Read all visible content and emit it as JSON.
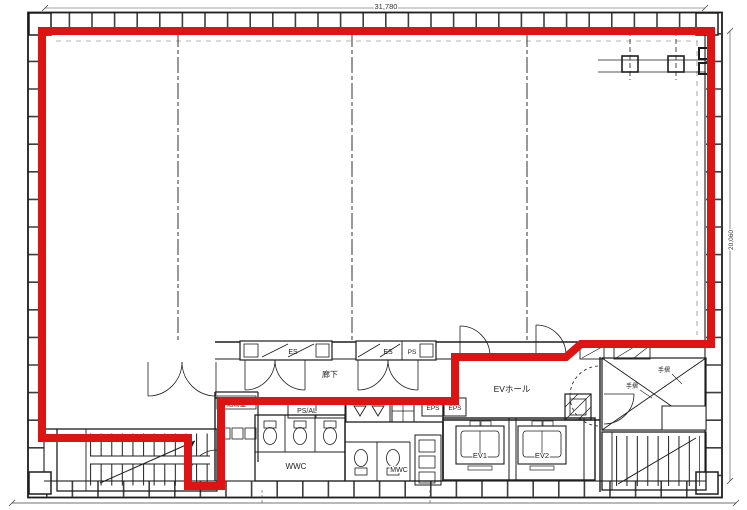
{
  "plan": {
    "type": "architectural floor plan with leased area outlined in red",
    "colors": {
      "lease_outline": "#dd1414",
      "linework": "#1d1d1d",
      "background": "#ffffff"
    },
    "dimensions": {
      "top_width": "31,780",
      "right_height": "20,060"
    },
    "labels": {
      "corridor": "廊下",
      "ev_hall": "EVホール",
      "elevator_1": "EV1",
      "elevator_2": "EV2",
      "womens_wc": "WWC",
      "mens_wc": "MWC",
      "kitchenette": "給湯室",
      "ps_al": "PS/AL",
      "eps_left": "EPS",
      "eps_right": "EPS",
      "es_shaft_1": "ES",
      "es_shaft_2": "ES",
      "ps_shaft": "PS",
      "handrail_a": "手摺",
      "handrail_b": "手摺"
    }
  }
}
